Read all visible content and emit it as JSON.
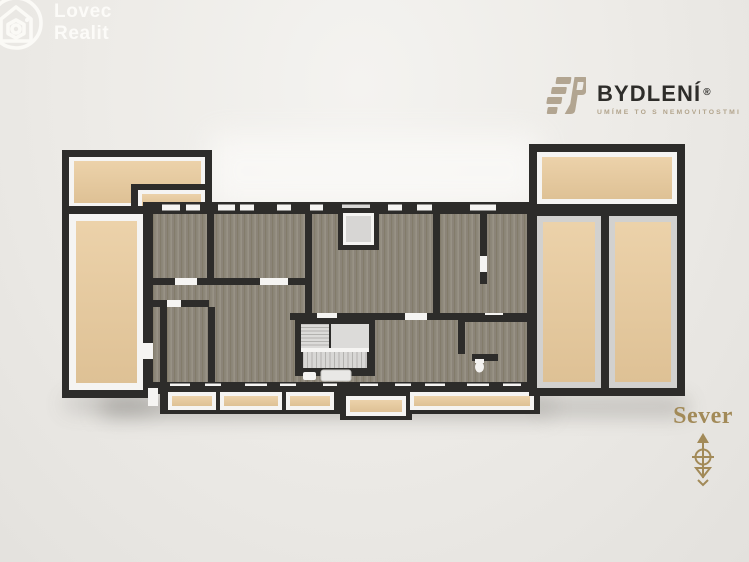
{
  "page": {
    "type": "3d-floor-plan-render"
  },
  "branding": {
    "lovec": {
      "line1": "Lovec",
      "line2": "Realit"
    },
    "bydleni": {
      "name": "BYDLENÍ",
      "registered": "®",
      "tagline": "UMÍME TO S NEMOVITOSTMI"
    }
  },
  "compass": {
    "label": "Sever"
  },
  "palette": {
    "background": "#edebe7",
    "wall": "#2d2c2a",
    "wall_cap": "#f5f4f2",
    "terrace_floor": "#e6cba3",
    "wood_floor": "#8d877a",
    "stair": "#dcdbd9",
    "brand_taupe": "#b2a48c",
    "brand_gold": "#a28a58",
    "logo_dark_text": "#2e2d2a",
    "logo_light_text": "#fcfbf8"
  },
  "floorplan_features": [
    "left-terraces",
    "right-terraces",
    "bottom-balconies",
    "wood-floor-rooms",
    "staircase",
    "elevator",
    "bathrooms",
    "window-openings"
  ]
}
